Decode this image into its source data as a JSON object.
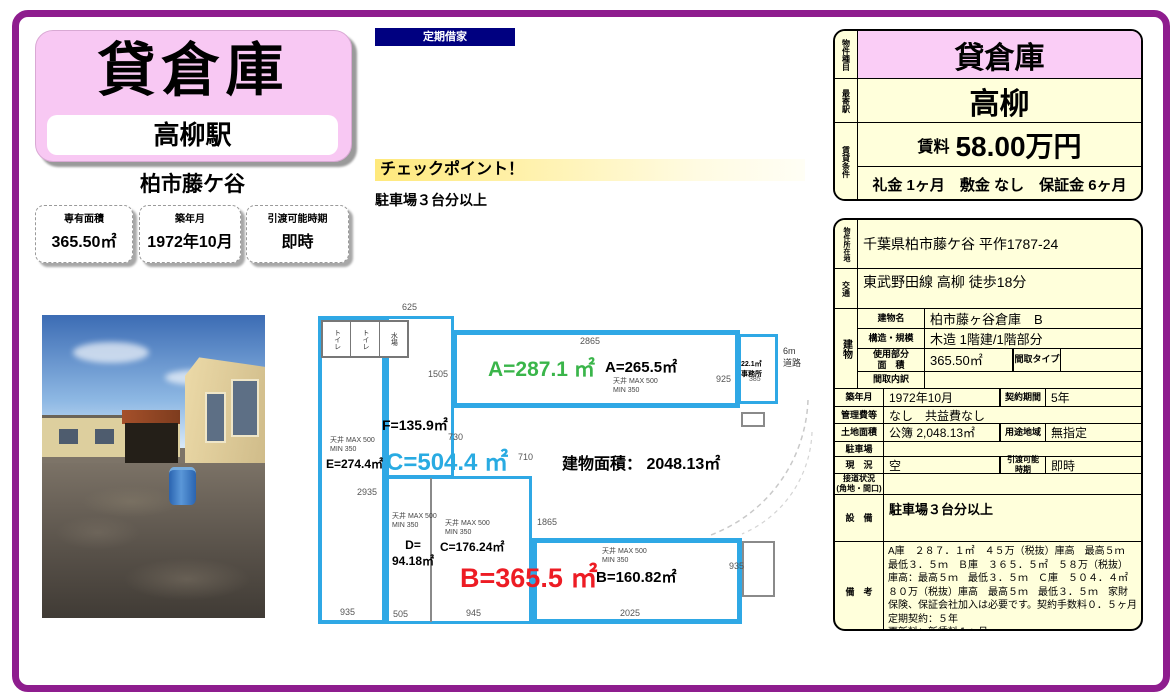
{
  "left": {
    "title": "貸倉庫",
    "station": "高柳駅",
    "location": "柏市藤ケ谷",
    "info_boxes": [
      {
        "label": "専有面積",
        "value": "365.50㎡"
      },
      {
        "label": "築年月",
        "value": "1972年10月"
      },
      {
        "label": "引渡可能時期",
        "value": "即時"
      }
    ]
  },
  "badge": "定期借家",
  "checkpoint": {
    "title": "チェックポイント！",
    "note": "駐車場３台分以上"
  },
  "plan": {
    "building_area_label": "建物面積： 2048.13㎡",
    "a_main": "A=287.1 ㎡",
    "a_sub": "A=265.5㎡",
    "b_main": "B=365.5 ㎡",
    "b_sub": "B=160.82㎡",
    "c_main": "C=504.4 ㎡",
    "c_sub": "C=176.24㎡",
    "d_sub": "D=\n94.18㎡",
    "e_sub": "E=274.4㎡",
    "f_sub": "F=135.9㎡",
    "office": "22.1㎡\n事務所",
    "road": "6m\n道路",
    "ceiling": "天井 MAX 500\nMIN 350",
    "rooms": [
      "トイレ",
      "トイレ",
      "水場"
    ],
    "dims": {
      "d625": "625",
      "d2865": "2865",
      "d1505": "1505",
      "d925": "925",
      "d385": "385",
      "d730": "730",
      "d710": "710",
      "d2935": "2935",
      "d1865": "1865",
      "d935a": "935",
      "d505": "505",
      "d945": "945",
      "d2025": "2025",
      "d935b": "935"
    },
    "colors": {
      "wall": "#2FA8E5",
      "a_text": "#3AB54A",
      "b_text": "#ED1C24",
      "c_text": "#29ABE2"
    }
  },
  "summary": {
    "type_label": "物件種目",
    "type": "貸倉庫",
    "station_label": "最寄駅",
    "station": "高柳",
    "terms_label": "賃貸条件",
    "rent_label": "賃料",
    "rent": "58.00万円",
    "terms": "礼金 1ヶ月　敷金 なし　保証金 6ヶ月"
  },
  "detail": {
    "address_label": "物件所在地",
    "address": "千葉県柏市藤ケ谷 平作1787-24",
    "transport_label": "交通",
    "transport": "東武野田線 高柳 徒歩18分",
    "building_label": "建物",
    "building_name_label": "建物名",
    "building_name": "柏市藤ヶ谷倉庫　B",
    "structure_label": "構造・規模",
    "structure": "木造 1階建/1階部分",
    "used_area_label": "使用部分\n面　積",
    "used_area": "365.50㎡",
    "madori_type_label": "間取タイプ",
    "madori_type": "",
    "madori_detail_label": "間取内訳",
    "madori_detail": "",
    "built_label": "築年月",
    "built": "1972年10月",
    "contract_label": "契約期間",
    "contract": "5年",
    "fees_label": "管理費等",
    "fees": "なし　共益費なし",
    "land_label": "土地面積",
    "land": "公簿 2,048.13㎡",
    "zone_label": "用途地域",
    "zone": "無指定",
    "parking_label": "駐車場",
    "parking": "",
    "status_label": "現　況",
    "status": "空",
    "handover_label": "引渡可能\n時期",
    "handover": "即時",
    "road_label": "接道状況\n(角地・間口)",
    "road": "",
    "equipment_label": "設　備",
    "equipment": "駐車場３台分以上",
    "remarks_label": "備　考",
    "remarks": "A庫　２８７．１㎡　４５万（税抜）庫高　最高５ｍ　最低３．５ｍ　Ｂ庫　３６５．５㎡　５８万（税抜）　庫高：最高５ｍ　最低３．５ｍ　Ｃ庫　５０４．４㎡　８０万（税抜）庫高　最高５ｍ　最低３．５ｍ　家財保険、保証会社加入は必要です。契約手数料０．５ヶ月　定期契約：５年\n更新料：新賃料１ヶ月"
  }
}
